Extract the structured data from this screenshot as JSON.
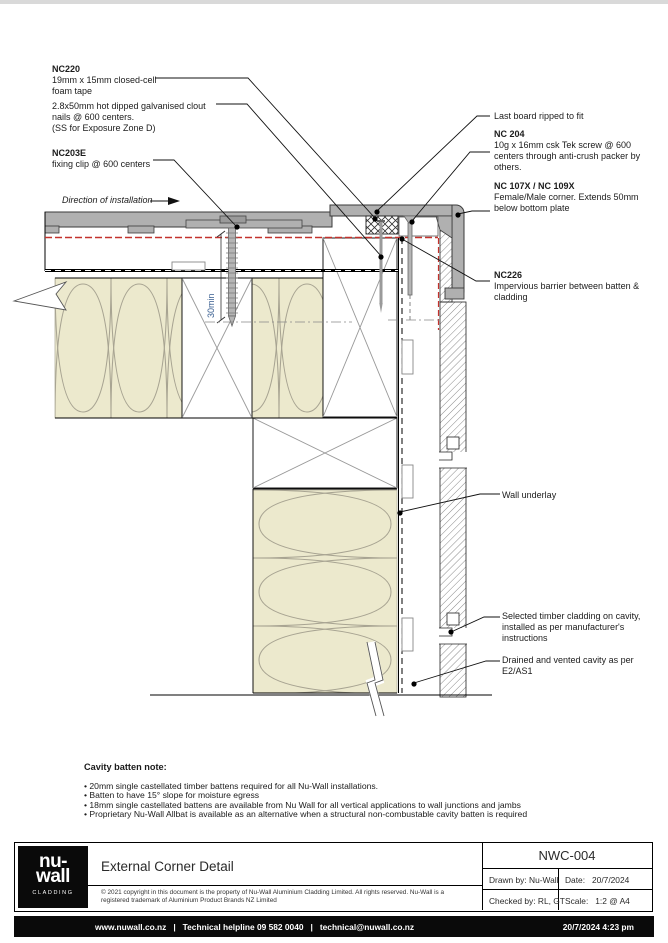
{
  "page": {
    "top_strip_color": "#d9d9d9"
  },
  "drawing": {
    "labels": {
      "nc220": {
        "code": "NC220",
        "lines": [
          "19mm x 15mm closed-cell",
          "foam tape"
        ]
      },
      "clout_nails": {
        "lines": [
          "2.8x50mm hot dipped galvanised clout",
          "nails @ 600 centers.",
          "(SS for Exposure Zone D)"
        ]
      },
      "nc203e": {
        "code": "NC203E",
        "lines": [
          "fixing clip @ 600 centers"
        ]
      },
      "direction": "Direction of installation",
      "last_board": "Last board ripped to fit",
      "nc204": {
        "code": "NC 204",
        "lines": [
          "10g x 16mm csk Tek screw @ 600",
          "centers through anti-crush packer by",
          "others."
        ]
      },
      "nc107x": {
        "code": "NC 107X / NC 109X",
        "lines": [
          "Female/Male corner. Extends 50mm",
          "below bottom plate"
        ]
      },
      "nc226": {
        "code": "NC226",
        "lines": [
          "Impervious barrier between batten &",
          "cladding"
        ]
      },
      "wall_underlay": "Wall underlay",
      "timber_cladding": {
        "lines": [
          "Selected timber cladding on cavity,",
          "installed as per manufacturer's",
          "instructions"
        ]
      },
      "drained_cavity": {
        "lines": [
          "Drained and vented cavity as per",
          "E2/AS1"
        ]
      },
      "dim_30min": "30min"
    },
    "colors": {
      "insulation": "#ece9cd",
      "profile_gray": "#b0b0b0",
      "red_line": "#c3322d",
      "dim_blue": "#3a5f91"
    }
  },
  "notes": {
    "title": "Cavity batten note:",
    "bullets": [
      "20mm single castellated timber battens required for all Nu-Wall installations.",
      "Batten to have 15° slope for moisture egress",
      "18mm single castellated battens are available from Nu Wall for all vertical applications to wall junctions and jambs",
      "Proprietary Nu-Wall Allbat is available as an alternative when a structural non-combustable cavity batten is required"
    ]
  },
  "title_block": {
    "logo": {
      "line1": "nu-",
      "line2": "wall",
      "sub": "CLADDING"
    },
    "title": "External Corner Detail",
    "copyright": "© 2021 copyright in this document is the property of Nu-Wall Aluminium Cladding Limited. All rights reserved. Nu-Wall is a registered trademark of Aluminium Product Brands NZ Limited",
    "drawing_no": "NWC-004",
    "drawn_by_label": "Drawn by:",
    "drawn_by": "Nu-Wall",
    "date_label": "Date:",
    "date": "20/7/2024",
    "checked_by_label": "Checked by:",
    "checked_by": "RL, GT",
    "scale_label": "Scale:",
    "scale": "1:2 @ A4"
  },
  "footer": {
    "contact": "www.nuwall.co.nz   |   Technical helpline 09 582 0040   |   technical@nuwall.co.nz",
    "timestamp": "20/7/2024 4:23 pm"
  }
}
